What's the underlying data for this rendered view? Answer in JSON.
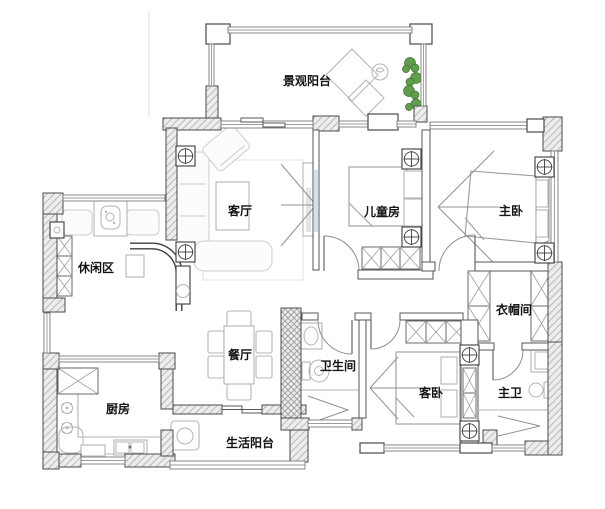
{
  "rooms": {
    "scenic_balcony": "景观阳台",
    "living_room": "客厅",
    "kids_room": "儿童房",
    "master_bedroom": "主卧",
    "leisure_area": "休闲区",
    "cloakroom": "衣帽间",
    "dining_room": "餐厅",
    "bathroom": "卫生间",
    "guest_bedroom": "客卧",
    "master_bathroom": "主卫",
    "kitchen": "厨房",
    "service_balcony": "生活阳台"
  },
  "colors": {
    "background": "#ffffff",
    "wall_stroke": "#4a4a4a",
    "text": "#141414",
    "plant_green": "#5f9e4c",
    "glass_blue": "#cfe2ef"
  }
}
